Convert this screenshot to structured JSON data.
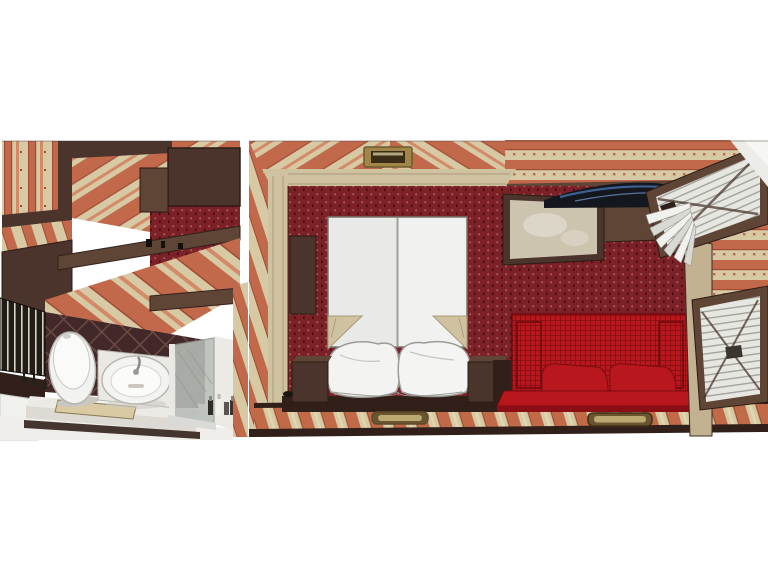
{
  "scene": {
    "type": "3d-interior-render",
    "description": "Cutaway rendering of a cabin suite: bathroom, bedroom with double bed, lounge with red sofa, and adjacent folded-berth compartment",
    "rooms": [
      {
        "name": "bathroom",
        "items": [
          "toilet",
          "washbasin",
          "vanity-counter",
          "shower-glass",
          "toiletries",
          "tub-deck",
          "slatted-window",
          "wall-cabinets"
        ]
      },
      {
        "name": "bedroom",
        "items": [
          "ceiling-lamp",
          "wardrobe-doors",
          "double-bed",
          "pillows",
          "nightstand-left",
          "nightstand-right",
          "floor-hatch-handle"
        ]
      },
      {
        "name": "lounge",
        "items": [
          "mirror",
          "tv-panel",
          "wall-cabinet",
          "red-sofa",
          "sofa-cushions",
          "floor-hatch-handle"
        ]
      },
      {
        "name": "berth-compartment",
        "items": [
          "folded-upper-berth",
          "pleated-curtain",
          "folded-lower-berth",
          "wall-post"
        ]
      }
    ]
  },
  "palette": {
    "bg": "#ffffff",
    "stripe_cream": "#d7c9a3",
    "stripe_orange": "#c1694a",
    "stripe_orange_light": "#d28a68",
    "stripe_line": "#a14a34",
    "red_wall": "#7b2127",
    "red_motif": "#aa6156",
    "red_dark_dash": "#430d12",
    "wood_dark": "#4a342b",
    "wood_mid": "#5e4536",
    "wood_deep": "#31201a",
    "trim_cream": "#cfc2a0",
    "trim_line": "#b2a482",
    "floor_cream": "#d7c9a3",
    "floor_orange": "#c06a48",
    "floor_line": "#9c4f33",
    "tile_base": "#432829",
    "tile_line": "#6d4c45",
    "fixture_white": "#f3f3f1",
    "fixture_shade": "#c7c5bf",
    "glass_grey": "#b7bcb7",
    "sofa_red": "#b7171d",
    "sofa_red_dark": "#8a0e13",
    "slat_light": "#e7e7e2",
    "slat_line": "#a3a39c",
    "mirror_beige": "#cdc4b0",
    "tv_dark": "#14171d",
    "tv_blue": "#3d5f91",
    "brass": "#a08648",
    "brass_dark": "#5e4a28",
    "post_tan": "#c3b292",
    "window_dark": "#221c16",
    "window_slat": "#d8d2c4",
    "cut_white": "#ecece8"
  }
}
